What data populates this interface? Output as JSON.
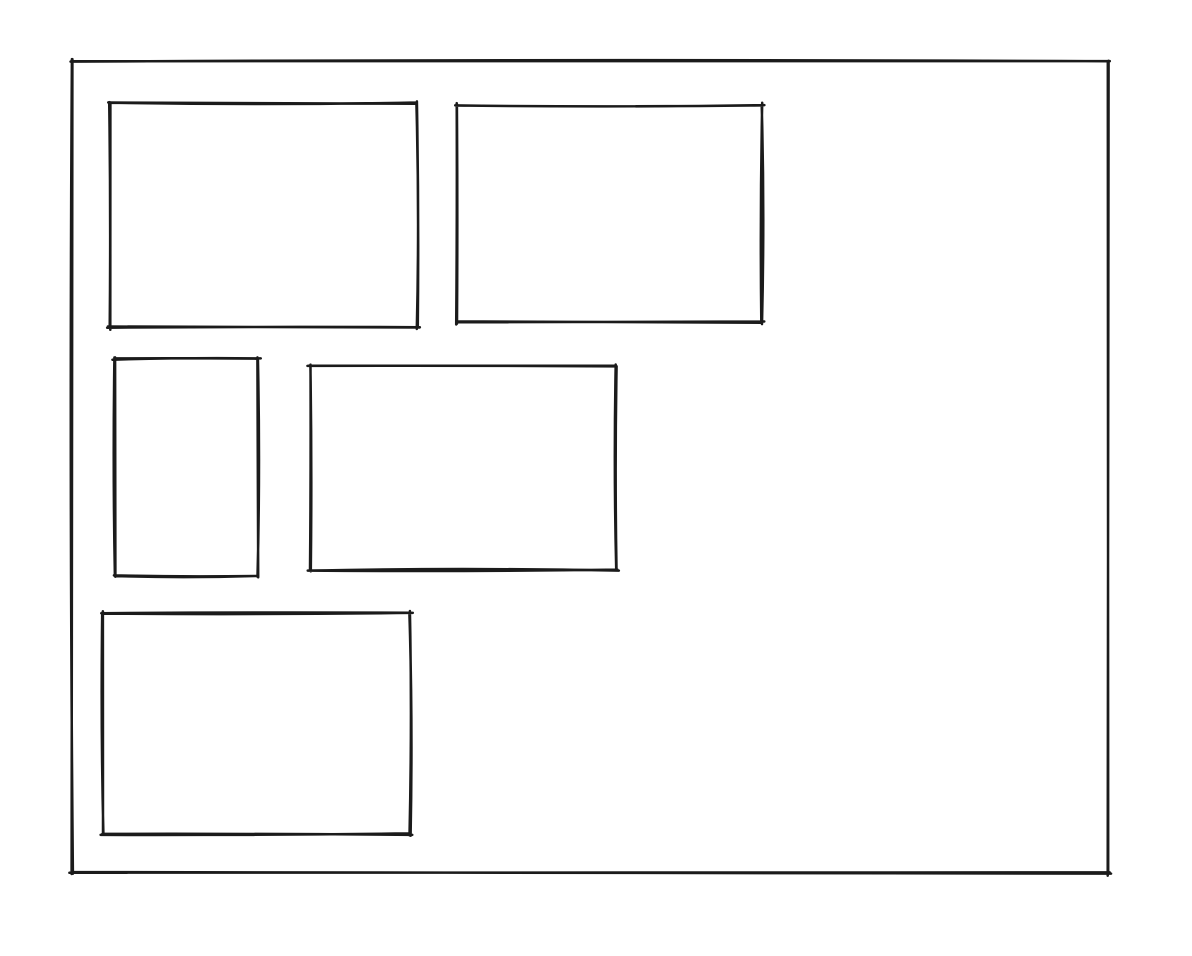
{
  "diagram": {
    "type": "hand-drawn-wireframe",
    "canvas": {
      "width": 1192,
      "height": 956,
      "background": "#ffffff"
    },
    "stroke": {
      "color": "#1b1b1b",
      "width": 2.5,
      "style": "rough-sketch",
      "passes": 2
    },
    "shapes": [
      {
        "name": "outer-frame",
        "type": "rectangle",
        "x": 72,
        "y": 61,
        "width": 1036,
        "height": 812,
        "roughness": 2.6,
        "seed": 11
      },
      {
        "name": "panel-top-left",
        "type": "rectangle",
        "x": 110,
        "y": 103,
        "width": 307,
        "height": 224,
        "roughness": 2.3,
        "seed": 23
      },
      {
        "name": "panel-top-right",
        "type": "rectangle",
        "x": 457,
        "y": 105,
        "width": 305,
        "height": 217,
        "roughness": 2.4,
        "seed": 37
      },
      {
        "name": "panel-middle-left",
        "type": "rectangle",
        "x": 115,
        "y": 359,
        "width": 143,
        "height": 217,
        "roughness": 2.2,
        "seed": 51
      },
      {
        "name": "panel-middle-center",
        "type": "rectangle",
        "x": 310,
        "y": 366,
        "width": 306,
        "height": 204,
        "roughness": 2.3,
        "seed": 67
      },
      {
        "name": "panel-bottom-left",
        "type": "rectangle",
        "x": 103,
        "y": 613,
        "width": 307,
        "height": 221,
        "roughness": 2.6,
        "seed": 83
      }
    ]
  }
}
